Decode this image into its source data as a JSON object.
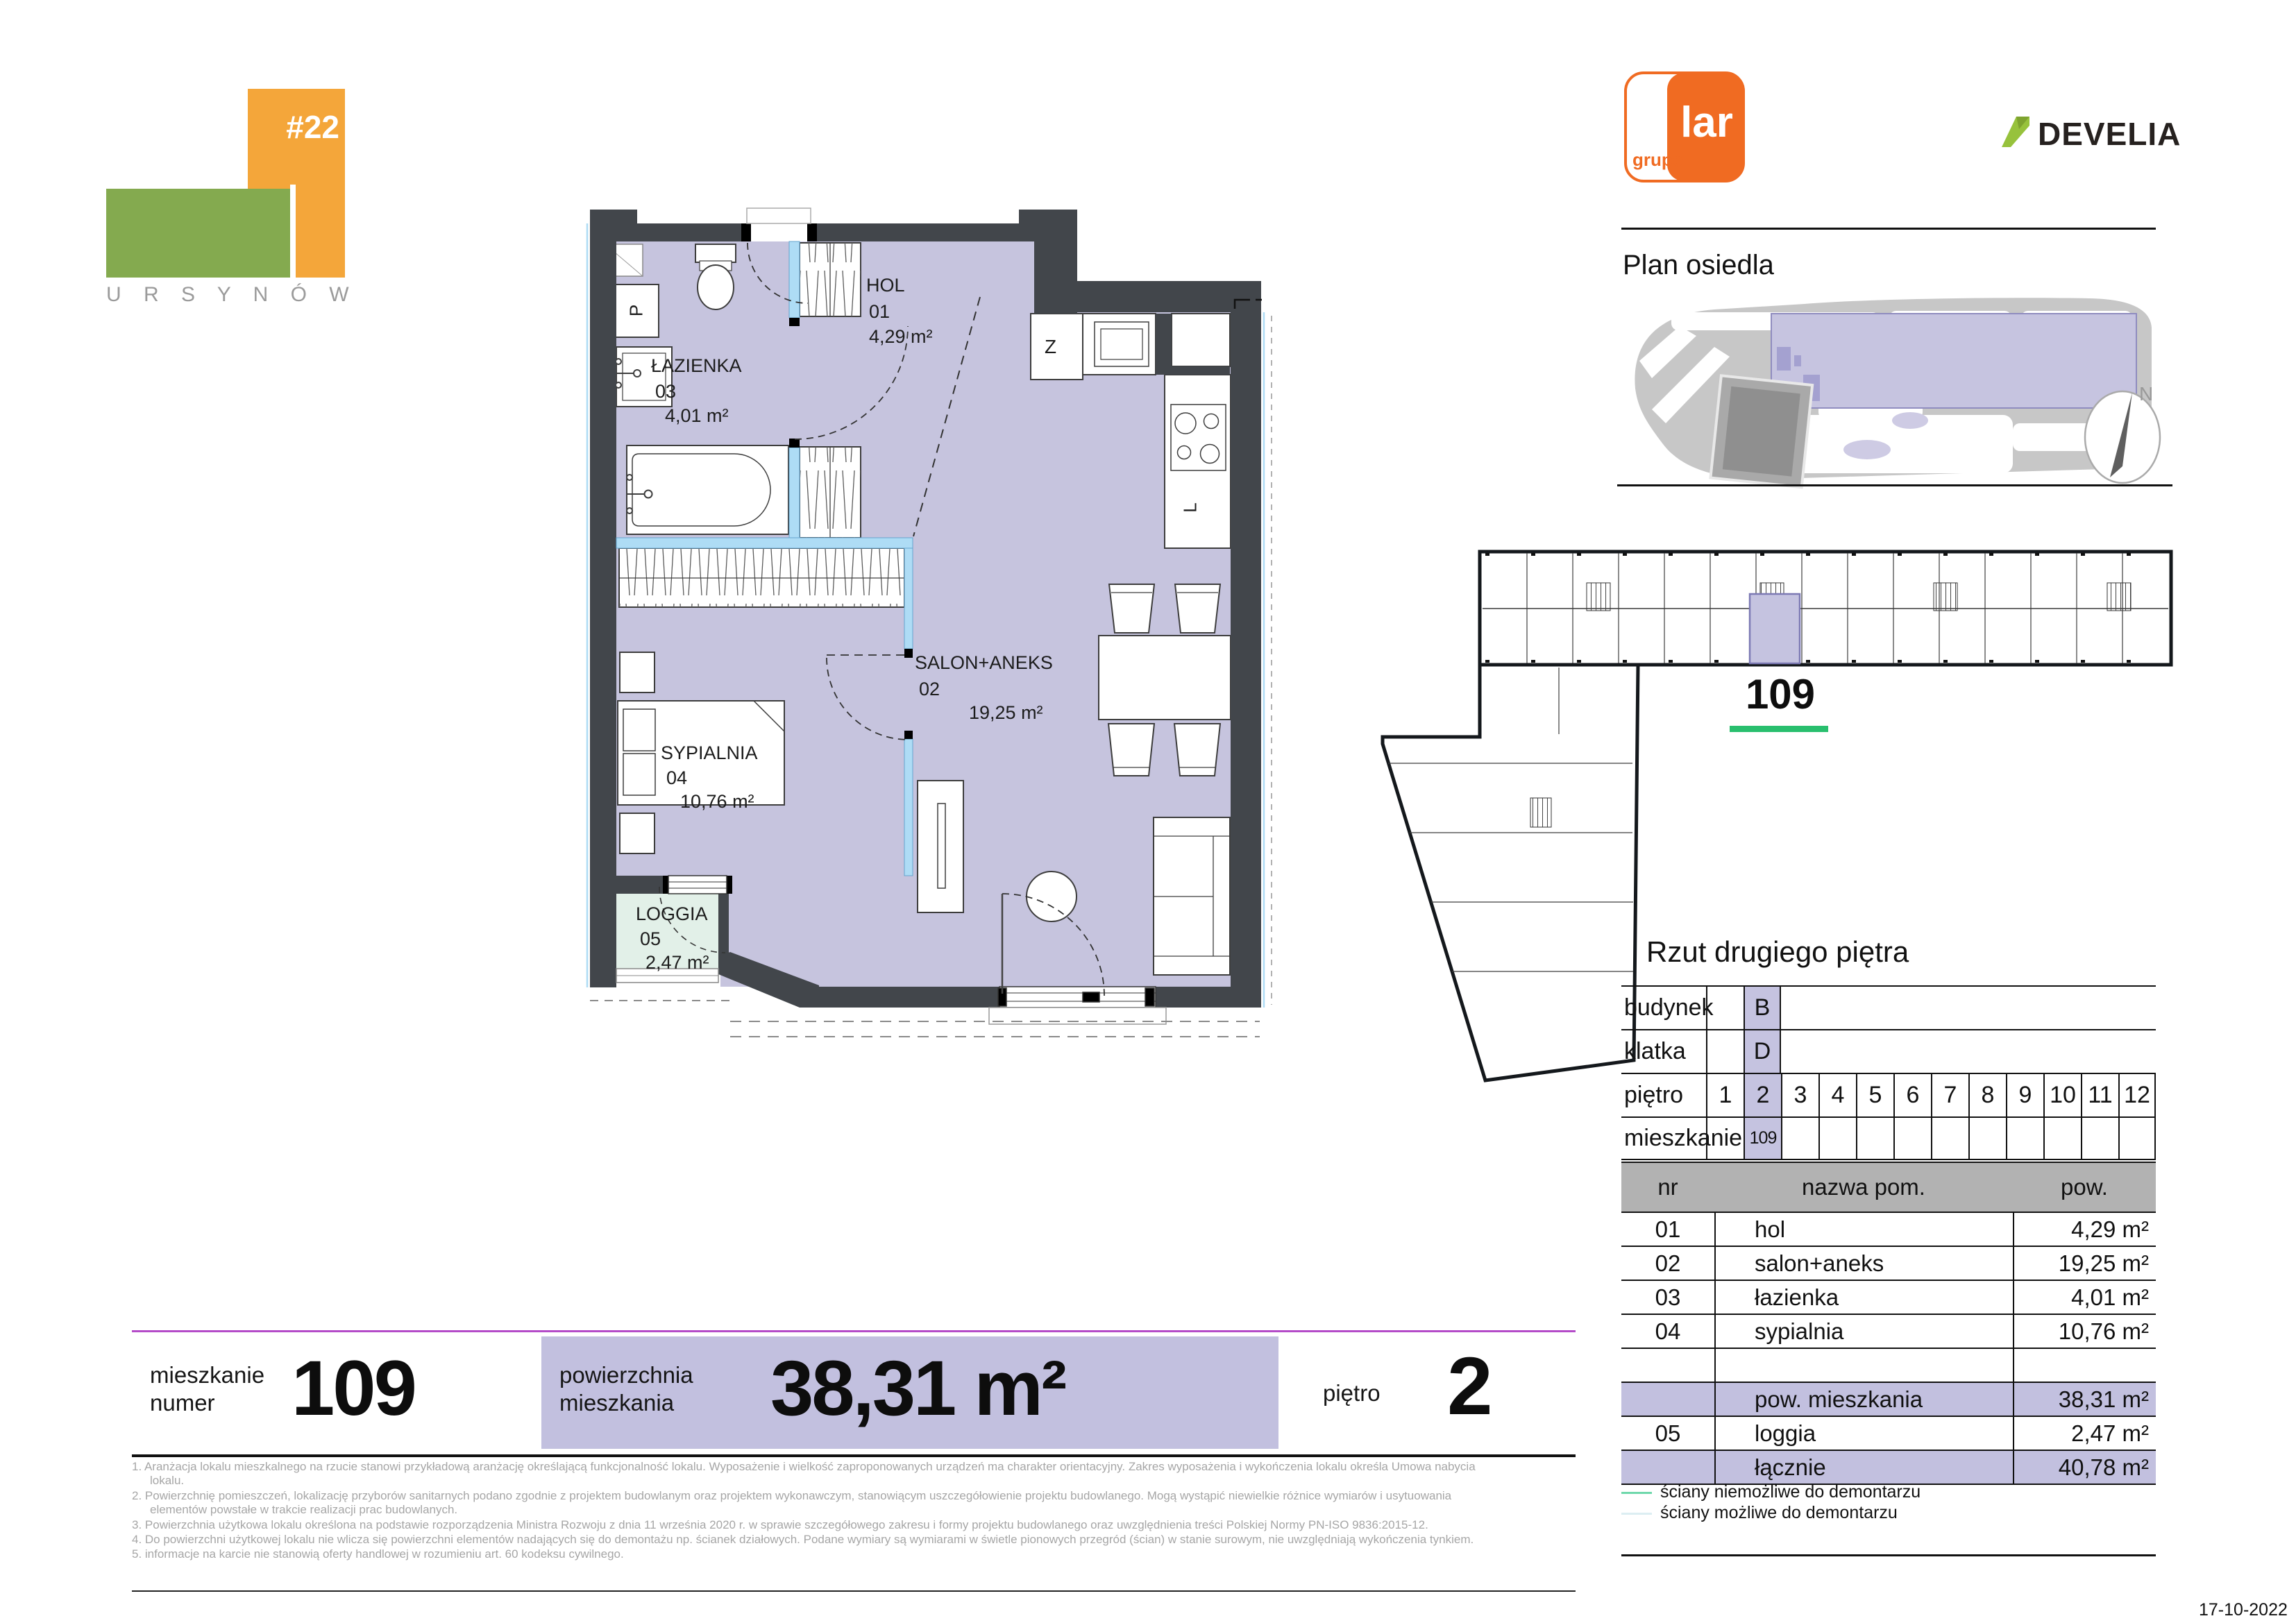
{
  "project_logo": {
    "number": "#22",
    "district": "U R S Y N Ó W"
  },
  "brands": {
    "grupo": "grupo",
    "lar": "lar",
    "develia": "DEVELIA"
  },
  "site_plan": {
    "title": "Plan osiedla",
    "compass": "N"
  },
  "floor_overview": {
    "highlighted_unit": "109"
  },
  "floor_section": {
    "title": "Rzut drugiego piętra"
  },
  "unit_table": {
    "budynek_label": "budynek",
    "budynek_value": "B",
    "klatka_label": "klatka",
    "klatka_value": "D",
    "pietro_label": "piętro",
    "floors": [
      "1",
      "2",
      "3",
      "4",
      "5",
      "6",
      "7",
      "8",
      "9",
      "10",
      "11",
      "12"
    ],
    "mieszkanie_label": "mieszkanie",
    "mieszkanie_value": "109"
  },
  "rooms_table": {
    "headers": {
      "nr": "nr",
      "name": "nazwa pom.",
      "area": "pow."
    },
    "rows": [
      {
        "nr": "01",
        "name": "hol",
        "area": "4,29 m²"
      },
      {
        "nr": "02",
        "name": "salon+aneks",
        "area": "19,25 m²"
      },
      {
        "nr": "03",
        "name": "łazienka",
        "area": "4,01 m²"
      },
      {
        "nr": "04",
        "name": "sypialnia",
        "area": "10,76 m²"
      },
      {
        "nr": "",
        "name": "",
        "area": ""
      },
      {
        "nr": "",
        "name": "pow. mieszkania",
        "area": "38,31 m²"
      },
      {
        "nr": "05",
        "name": "loggia",
        "area": "2,47 m²"
      },
      {
        "nr": "",
        "name": "łącznie",
        "area": "40,78 m²"
      }
    ]
  },
  "plan": {
    "rooms": [
      {
        "name": "HOL",
        "num": "01",
        "area": "4,29 m²"
      },
      {
        "name": "SALON+ANEKS",
        "num": "02",
        "area": "19,25 m²"
      },
      {
        "name": "ŁAZIENKA",
        "num": "03",
        "area": "4,01 m²"
      },
      {
        "name": "SYPIALNIA",
        "num": "04",
        "area": "10,76 m²"
      },
      {
        "name": "LOGGIA",
        "num": "05",
        "area": "2,47 m²"
      }
    ],
    "fixtures": {
      "washer": "P",
      "closet": "Z",
      "fridge": "L"
    }
  },
  "summary_bar": {
    "unit_label": "mieszkanie\nnumer",
    "unit_value": "109",
    "area_label": "powierzchnia\nmieszkania",
    "area_value": "38,31 m²",
    "floor_label": "piętro",
    "floor_value": "2"
  },
  "footnotes": [
    "1. Aranżacja lokalu mieszkalnego na rzucie stanowi przykładową aranżację określającą funkcjonalność lokalu. Wyposażenie i wielkość zaproponowanych urządzeń ma charakter orientacyjny. Zakres wyposażenia i wykończenia lokalu określa Umowa nabycia lokalu.",
    "2. Powierzchnię pomieszczeń, lokalizację przyborów sanitarnych podano zgodnie z projektem budowlanym oraz projektem wykonawczym, stanowiącym uszczegółowienie projektu budowlanego. Mogą wystąpić niewielkie różnice wymiarów i usytuowania elementów powstałe w trakcie realizacji prac budowlanych.",
    "3. Powierzchnia użytkowa lokalu określona na podstawie rozporządzenia Ministra Rozwoju z dnia 11 września 2020 r. w sprawie szczegółowego zakresu i formy projektu budowlanego oraz uwzględnienia treści Polskiej Normy PN-ISO 9836:2015-12.",
    "4. Do powierzchni użytkowej lokalu nie wlicza się powierzchni elementów nadających się do demontażu np. ścianek działowych. Podane wymiary są wymiarami w świetle pionowych przegród (ścian) w stanie surowym, nie uwzględniają wykończenia tynkiem.",
    "5. informacje na karcie nie stanowią oferty handlowej w rozumieniu art. 60 kodeksu cywilnego."
  ],
  "legend": [
    {
      "label": "ściany niemożliwe do demontarzu",
      "color": "#6fd8ab"
    },
    {
      "label": "ściany możliwe do demontarzu",
      "color": "#dceef2"
    }
  ],
  "date": "17-10-2022",
  "colors": {
    "logo_orange": "#f4a63a",
    "logo_green": "#84aa4f",
    "grupolar_orange": "#f06b22",
    "develia_green": "#97c23c",
    "wall_dark": "#42464b",
    "floor_lavender": "#c6c4de",
    "loggia_mint": "#e2f0e8",
    "demountable_blue": "#aedcf5",
    "highlight_lavender": "#c2c0df",
    "green_underline": "#29bf6e",
    "magenta_line": "#b44bc8"
  }
}
